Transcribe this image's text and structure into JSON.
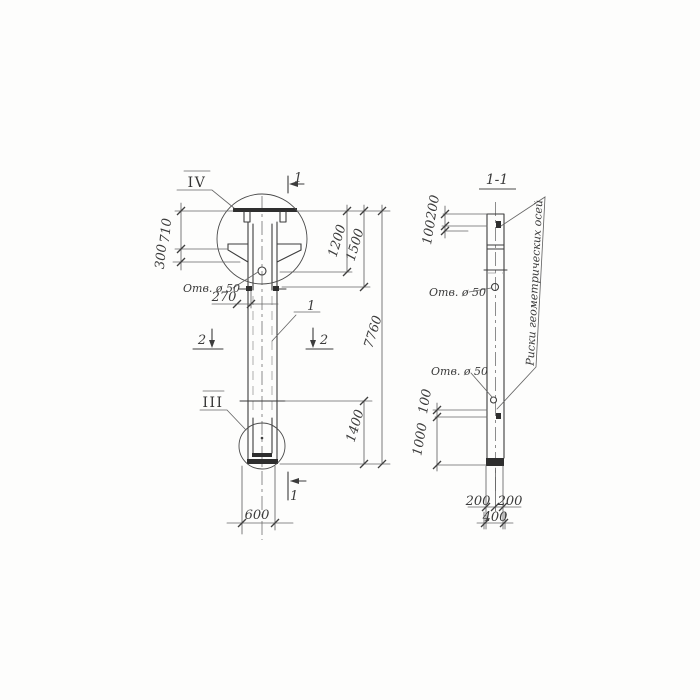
{
  "front_view": {
    "detail_top": "IV",
    "detail_bottom": "III",
    "cut1_top": "1",
    "cut1_bottom": "1",
    "cut2_left": "2",
    "cut2_right": "2",
    "part_ref": "1",
    "hole_note": "Отв. ø 50",
    "dims": {
      "top_offset": "710",
      "collar": "300",
      "hole_offset": "270",
      "to_hole": "1200",
      "to_mark": "1500",
      "total": "7760",
      "bottom_mark": "1400",
      "width": "600"
    }
  },
  "section_view": {
    "title": "1-1",
    "hole_note_top": "Отв. ø 50",
    "hole_note_bottom": "Отв. ø 50",
    "axes_note": "Риски геометрических осей",
    "dims": {
      "top_200": "200",
      "top_100": "100",
      "bottom_100": "100",
      "bottom_1000": "1000",
      "half_left": "200",
      "half_right": "200",
      "width": "400"
    }
  }
}
